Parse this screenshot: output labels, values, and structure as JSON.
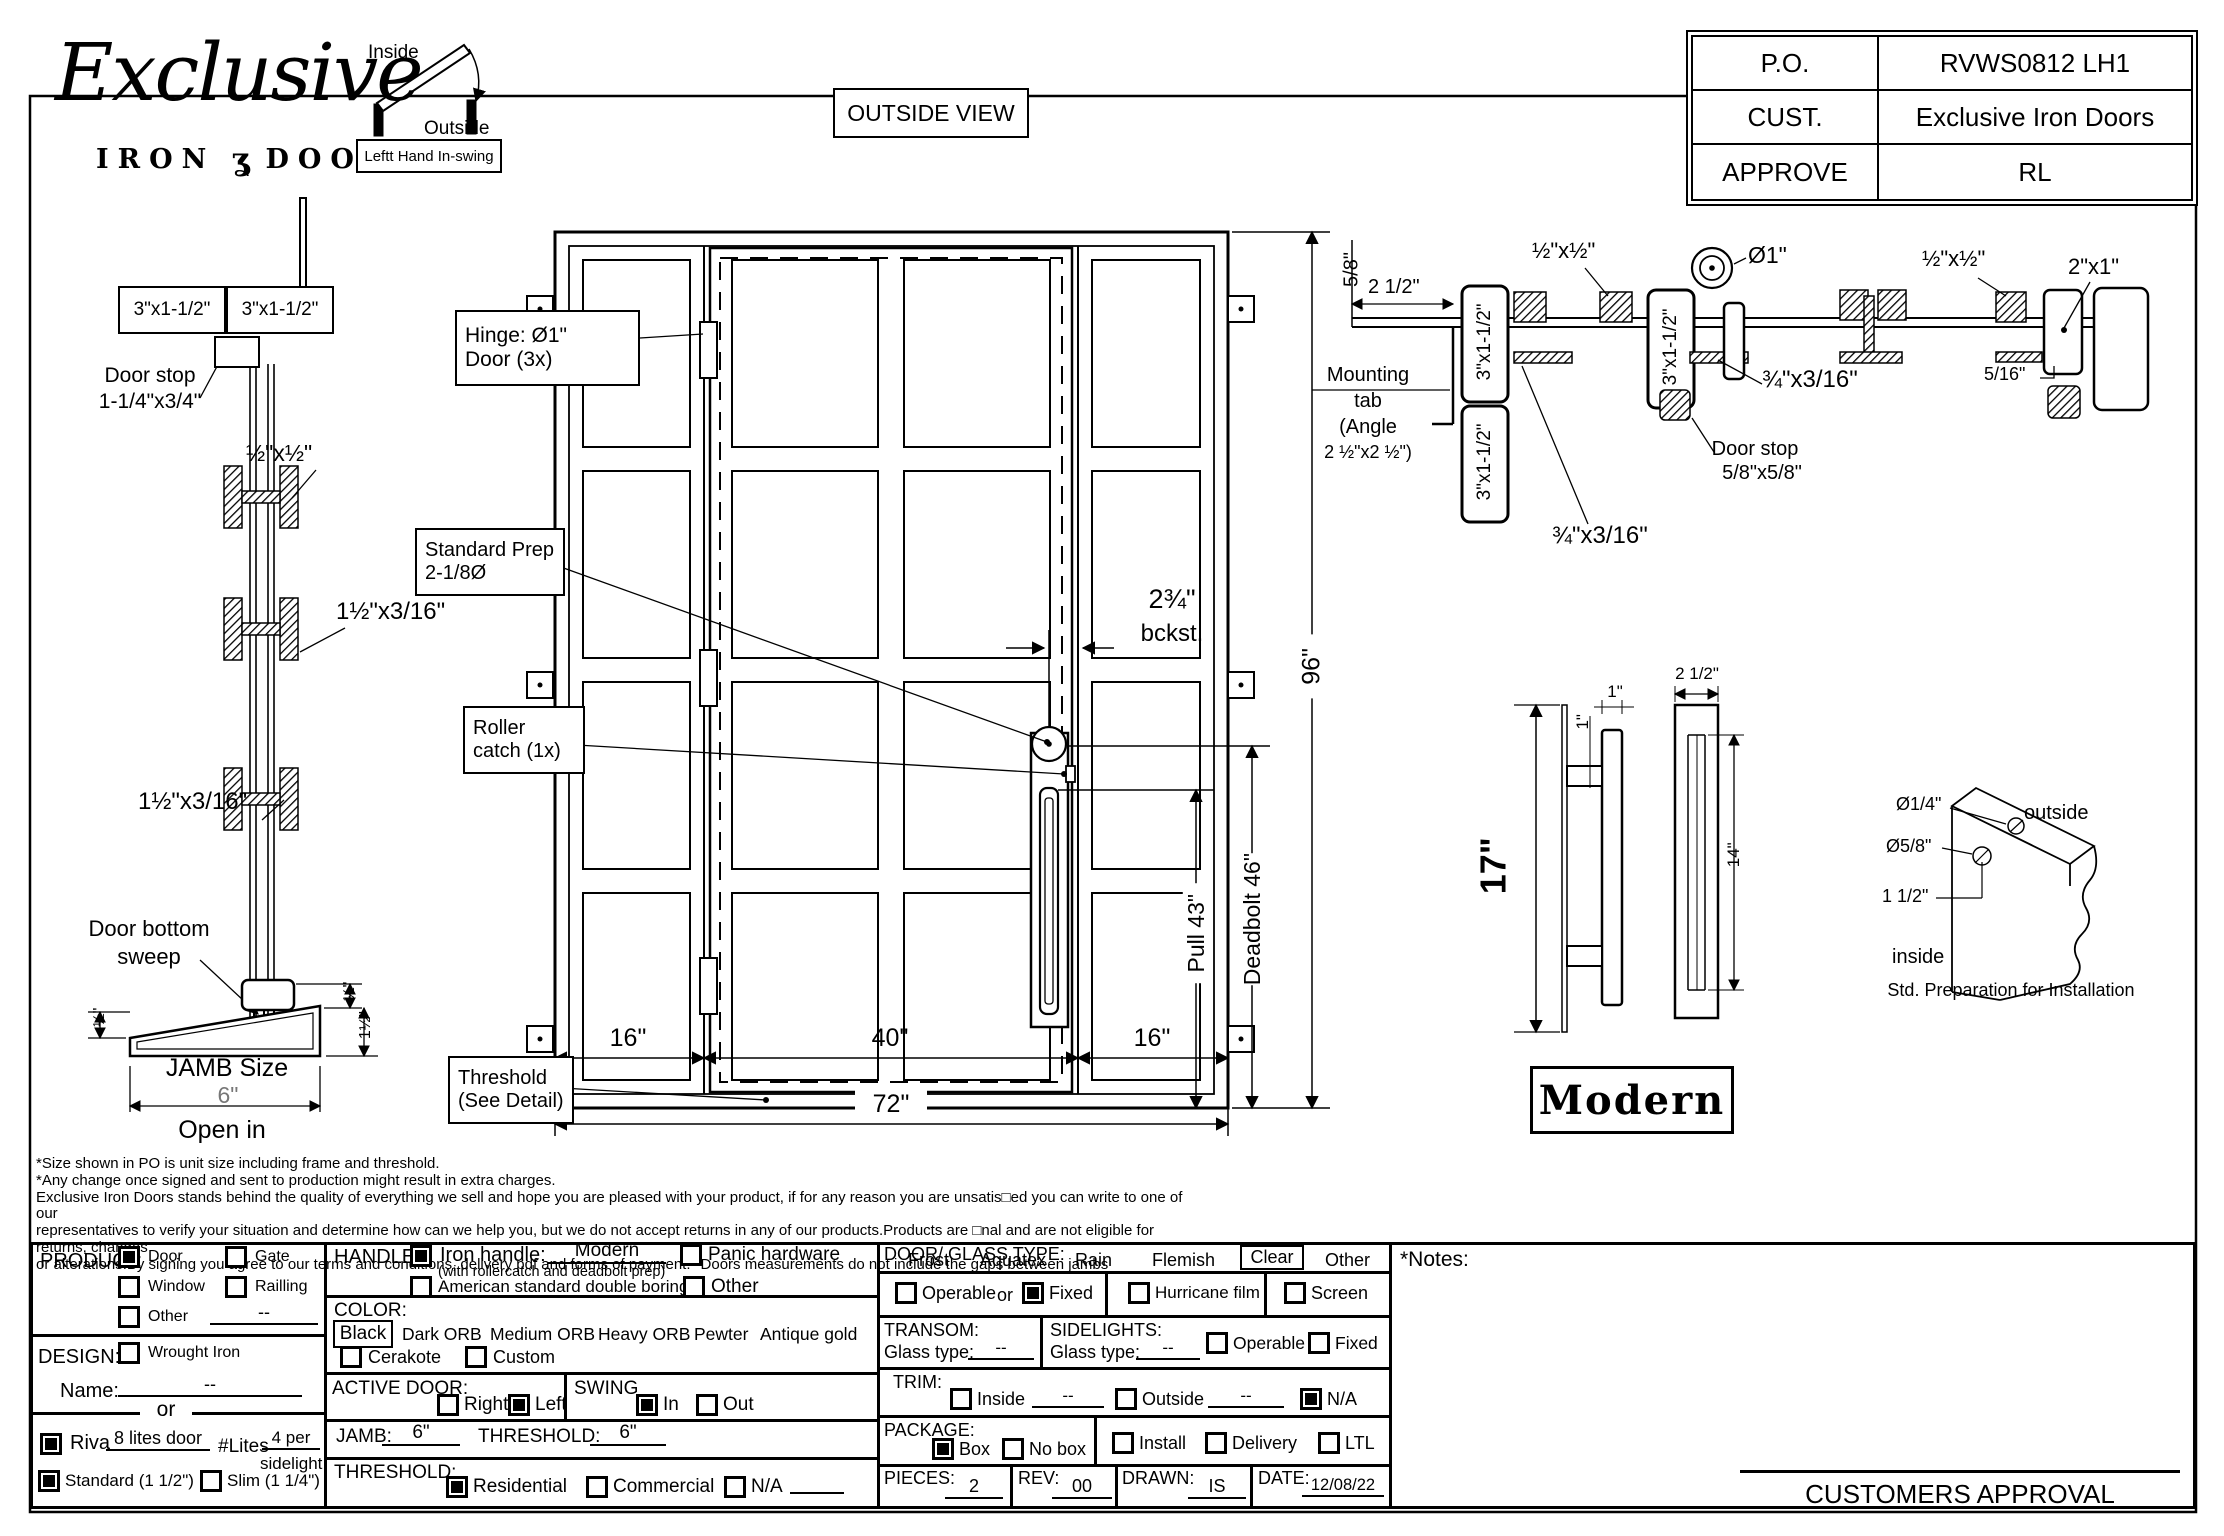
{
  "logo": {
    "script": "Exclusive",
    "iron": "IRON",
    "ornament": "ʓ",
    "doors": "DOORS"
  },
  "swing": {
    "inside": "Inside",
    "outside": "Outside",
    "caption": "Leftt Hand In-swing"
  },
  "view_label": "OUTSIDE VIEW",
  "info": {
    "po_l": "P.O.",
    "po_v": "RVWS0812 LH1",
    "cust_l": "CUST.",
    "cust_v": "Exclusive Iron Doors",
    "app_l": "APPROVE",
    "app_v": "RL"
  },
  "jamb": {
    "tube_a": "3\"x1-1/2\"",
    "tube_b": "3\"x1-1/2\"",
    "stop_1": "Door stop",
    "stop_2": "1-1/4\"x3/4\"",
    "anchor": "½\"x½\"",
    "flat_1": "1½\"x3/16\"",
    "flat_2": "1½\"x3/16\"",
    "sweep_1": "Door bottom",
    "sweep_2": "sweep",
    "half_l": "½\"",
    "half_r": "½\"",
    "one_half": "1½\"",
    "size_l": "JAMB Size",
    "size_v": "6\"",
    "open": "Open in"
  },
  "elev": {
    "hinge_1": "Hinge: Ø1\"",
    "hinge_2": "Door (3x)",
    "prep_1": "Standard Prep",
    "prep_2": "2-1/8Ø",
    "roller_1": "Roller",
    "roller_2": "catch (1x)",
    "thr_1": "Threshold",
    "thr_2": "(See Detail)",
    "bck_1": "2¾\"",
    "bck_2": "bckst.",
    "d16l": "16\"",
    "d40": "40\"",
    "d16r": "16\"",
    "d72": "72\"",
    "d96": "96\"",
    "dpull": "Pull 43\"",
    "ddead": "Deadbolt 46\""
  },
  "head": {
    "d58": "5/8\"",
    "d212": "2 1/2\"",
    "m1": "Mounting",
    "m2": "tab",
    "m3": "(Angle",
    "m4": "2 ½\"x2 ½\")",
    "tube_a": "3\"x1-1/2\"",
    "tube_b": "3\"x1-1/2\"",
    "tube_c": "3\"x1-1/2\"",
    "anchor_1": "½\"x½\"",
    "anchor_2": "½\"x½\"",
    "hinge": "Ø1\"",
    "flat_1": "¾\"x3/16\"",
    "flat_2": "¾\"x3/16\"",
    "stop_1": "Door stop",
    "stop_2": "5/8\"x5/8\"",
    "gap": "5/16\"",
    "t21": "2\"x1\""
  },
  "handle": {
    "h17": "17\"",
    "one_a": "1\"",
    "one_b": "1\"",
    "w25": "2 1/2\"",
    "h14": "14\"",
    "style": "Modern"
  },
  "corner": {
    "small": "Ø1/4\"",
    "big": "Ø5/8\"",
    "sp": "1 1/2\"",
    "out": "outside",
    "in": "inside",
    "cap": "Std. Preparation for Installation"
  },
  "disclaimer": {
    "l1": "*Size shown in PO is unit size including frame and threshold.",
    "l2": "*Any change once signed and sent to production might result in extra charges.",
    "l3": "Exclusive Iron Doors stands behind the quality of everything we sell and hope you are pleased with your product, if for any reason you are unsatis□ed you can write to one of our",
    "l4": "representatives to verify your situation and determine how can we help you, but we do not accept returns in any of our products.Products are □nal and are not eligible for returns, changes",
    "l5": "or alterations.By signing you agree to our terms and conditions, delivery pdf and forms of payment. *Doors measurements do not include the gaps between jambs"
  },
  "form": {
    "product": {
      "title": "PRODUCT:",
      "door": {
        "label": "Door",
        "checked": true
      },
      "gate": {
        "label": "Gate",
        "checked": false
      },
      "window": {
        "label": "Window",
        "checked": false
      },
      "railling": {
        "label": "Railling",
        "checked": false
      },
      "other": {
        "label": "Other",
        "checked": false,
        "value": "--"
      }
    },
    "design": {
      "title": "DESIGN:",
      "wrought": {
        "label": "Wrought Iron",
        "checked": false
      },
      "name_l": "Name:",
      "name_v": "--",
      "or": "or"
    },
    "riva": {
      "checked": true,
      "label": "Riva",
      "value": "8 lites door",
      "lites_l": "#Lites",
      "lites_v1": "4 per",
      "lites_v2": "sidelight"
    },
    "standard": {
      "label": "Standard (1 1/2\")",
      "checked": true
    },
    "slim": {
      "label": "Slim (1 1/4\")",
      "checked": false
    },
    "handle": {
      "title": "HANDLE:",
      "iron": {
        "label": "Iron handle:",
        "checked": true,
        "value": "Modern",
        "note": "(with rollercatch and deadbolt prep)"
      },
      "american": {
        "label": "American standard double boring",
        "checked": false
      },
      "panic": {
        "label": "Panic hardware",
        "checked": false
      },
      "other": {
        "label": "Other",
        "checked": false
      }
    },
    "color": {
      "title": "COLOR:",
      "selected": "Black",
      "opt1": "Dark ORB",
      "opt2": "Medium ORB",
      "opt3": "Heavy ORB",
      "opt4": "Pewter",
      "opt5": "Antique gold",
      "cerakote": {
        "label": "Cerakote",
        "checked": false
      },
      "custom": {
        "label": "Custom",
        "checked": false
      }
    },
    "active": {
      "title": "ACTIVE DOOR:",
      "right": {
        "label": "Right",
        "checked": false
      },
      "left": {
        "label": "Left",
        "checked": true
      }
    },
    "swing": {
      "title": "SWING",
      "in": {
        "label": "In",
        "checked": true
      },
      "out": {
        "label": "Out",
        "checked": false
      }
    },
    "jamb": {
      "label": "JAMB:",
      "value": "6\""
    },
    "threshold_dim": {
      "label": "THRESHOLD:",
      "value": "6\""
    },
    "threshold": {
      "title": "THRESHOLD:",
      "res": {
        "label": "Residential",
        "checked": true
      },
      "com": {
        "label": "Commercial",
        "checked": false
      },
      "na": {
        "label": "N/A",
        "checked": false
      }
    },
    "glass": {
      "title": "DOOR/ GLASS TYPE:",
      "opt1": "Frost",
      "opt2": "Aquatex",
      "opt3": "Rain",
      "opt4": "Flemish",
      "selected": "Clear",
      "opt5": "Other"
    },
    "fixing": {
      "operable": {
        "label": "Operable",
        "checked": false
      },
      "or": "or",
      "fixed": {
        "label": "Fixed",
        "checked": true
      },
      "hurricane": {
        "label": "Hurricane film",
        "checked": false
      },
      "screen": {
        "label": "Screen",
        "checked": false
      }
    },
    "transom": {
      "title": "TRANSOM:",
      "glass_l": "Glass type:",
      "glass_v": "--"
    },
    "sidelights": {
      "title": "SIDELIGHTS:",
      "glass_l": "Glass type:",
      "glass_v": "--",
      "operable": {
        "label": "Operable",
        "checked": false
      },
      "fixed": {
        "label": "Fixed",
        "checked": false
      }
    },
    "trim": {
      "title": "TRIM:",
      "inside": {
        "label": "Inside",
        "checked": false,
        "value": "--"
      },
      "outside": {
        "label": "Outside",
        "checked": false,
        "value": "--"
      },
      "na": {
        "label": "N/A",
        "checked": true
      }
    },
    "package": {
      "title": "PACKAGE:",
      "box": {
        "label": "Box",
        "checked": true
      },
      "nobox": {
        "label": "No box",
        "checked": false
      },
      "install": {
        "label": "Install",
        "checked": false
      },
      "delivery": {
        "label": "Delivery",
        "checked": false
      },
      "ltl": {
        "label": "LTL",
        "checked": false
      }
    },
    "pieces": {
      "label": "PIECES:",
      "value": "2"
    },
    "rev": {
      "label": "REV:",
      "value": "00"
    },
    "drawn": {
      "label": "DRAWN:",
      "value": "IS"
    },
    "date": {
      "label": "DATE:",
      "value": "12/08/22"
    }
  },
  "notes_l": "*Notes:",
  "approval_l": "CUSTOMERS APPROVAL"
}
